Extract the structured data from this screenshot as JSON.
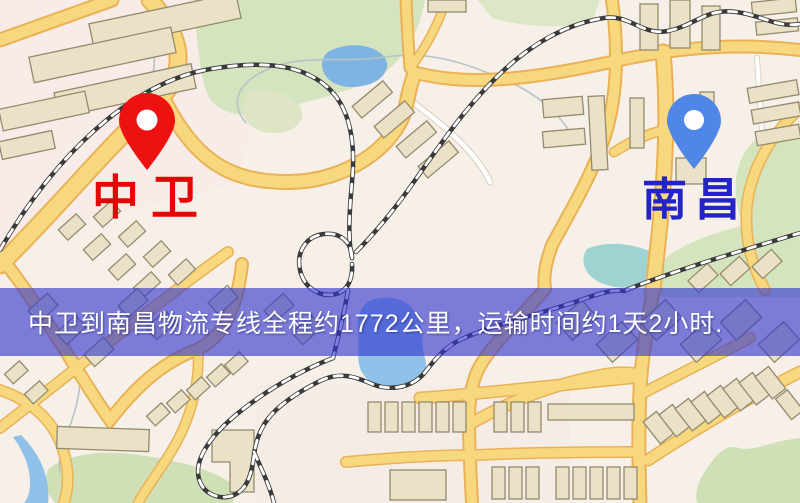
{
  "map": {
    "origin": {
      "label": "中卫"
    },
    "destination": {
      "label": "南昌"
    },
    "banner": {
      "text": "中卫到南昌物流专线全程约1772公里，运输时间约1天2小时."
    },
    "route": {
      "distance_text": "约1772公里",
      "duration_text": "约1天2小时"
    }
  },
  "colors": {
    "origin_pin": "#ee1111",
    "destination_pin": "#4f86e8",
    "origin_label": "#e60505",
    "destination_label": "#2323c8",
    "banner_background": "rgba(48,54,205,0.62)",
    "banner_text": "#ffffff",
    "road_fill": "#f8d87f",
    "park": "#d4e4bf",
    "water": "#8fc1e9"
  }
}
